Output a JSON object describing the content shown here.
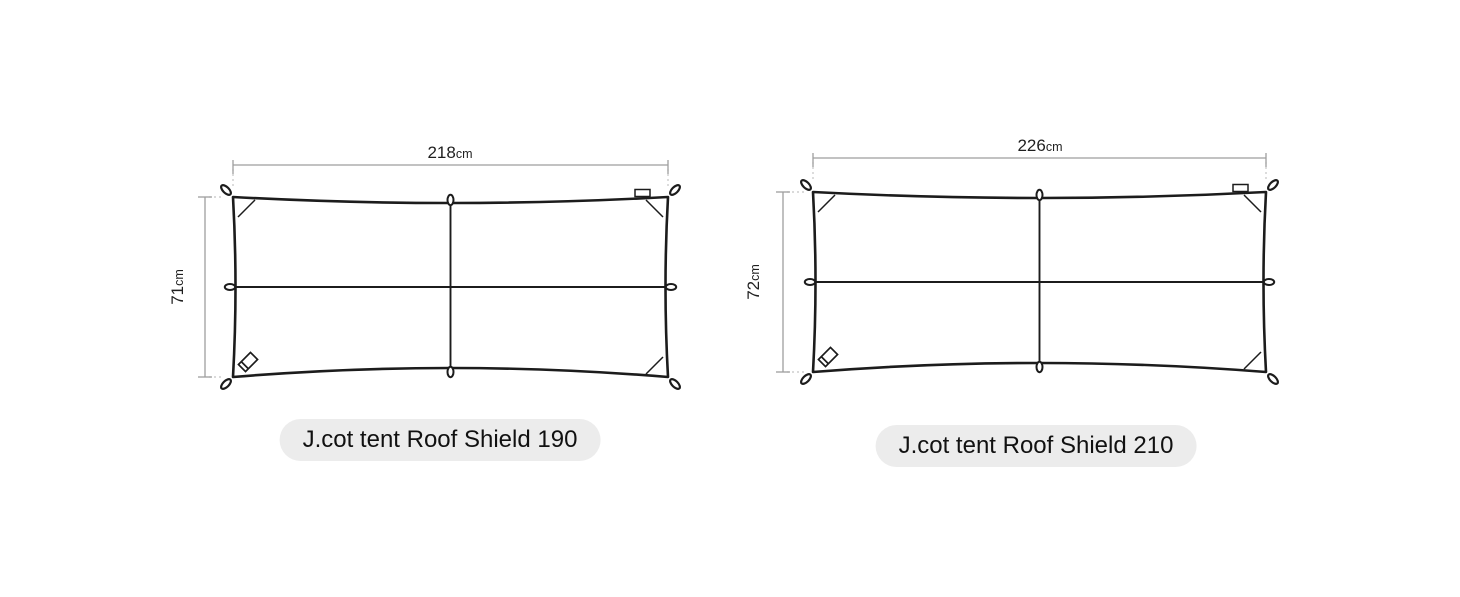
{
  "diagrams": [
    {
      "caption": "J.cot tent Roof Shield 190",
      "width_value": "218",
      "width_unit": "cm",
      "height_value": "71",
      "height_unit": "cm"
    },
    {
      "caption": "J.cot tent Roof Shield 210",
      "width_value": "226",
      "width_unit": "cm",
      "height_value": "72",
      "height_unit": "cm"
    }
  ],
  "colors": {
    "outline": "#1c1c1c",
    "dimension_line": "#9e9e9e",
    "extension_dotted": "#c4c4c4",
    "caption_bg": "#ececec",
    "caption_text": "#111111",
    "background": "#ffffff"
  }
}
